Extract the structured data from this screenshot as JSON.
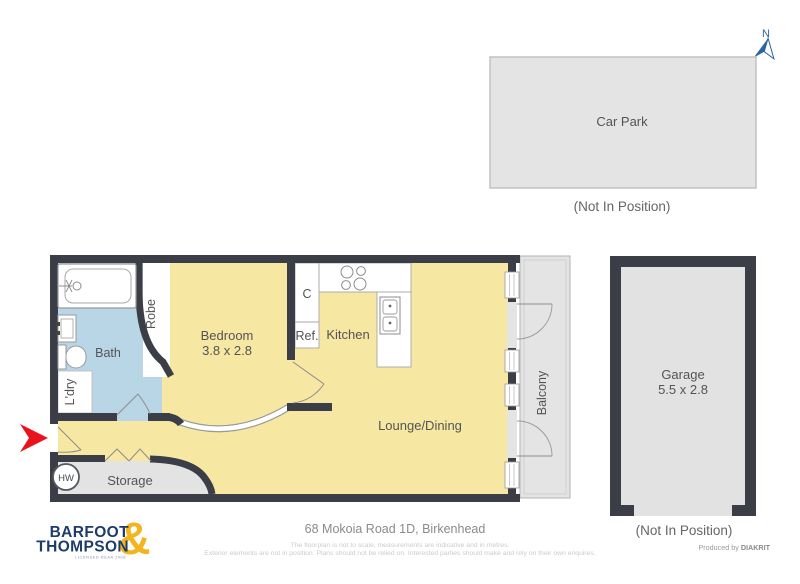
{
  "north": {
    "label": "N"
  },
  "car_park": {
    "label": "Car Park",
    "note": "(Not In Position)"
  },
  "garage": {
    "label": "Garage",
    "dims": "5.5 x 2.8",
    "note": "(Not In Position)"
  },
  "rooms": {
    "bath": "Bath",
    "robe": "Robe",
    "laundry": "L'dry",
    "bedroom": "Bedroom",
    "bedroom_dims": "3.8 x 2.8",
    "cupboard": "C",
    "fridge": "Ref.",
    "kitchen": "Kitchen",
    "lounge": "Lounge/Dining",
    "balcony": "Balcony",
    "storage": "Storage",
    "hot_water": "HW"
  },
  "footer": {
    "address": "68 Mokoia Road 1D, Birkenhead",
    "disclaimer1": "The floorplan is not to scale, measurements are indicative and in metres.",
    "disclaimer2": "Exterior elements are not in position. Plans should not be relied on. Interested parties should make and rely on their own enquires.",
    "produced_by": "Produced by ",
    "producer": "DIAKRIT"
  },
  "logo": {
    "word1": "BARFOOT",
    "word2": "THOMPSON",
    "ampersand": "&",
    "tagline": "LICENSED REAA 2008"
  },
  "colors": {
    "wall": "#3b3e47",
    "living": "#f6e8a3",
    "bathroom": "#b9d6e6",
    "outdoor": "#e4e4e5",
    "entry_arrow": "#e8131d",
    "logo_navy": "#1d3c6b",
    "logo_gold": "#f2b51e",
    "north_blue": "#2b63a5"
  }
}
